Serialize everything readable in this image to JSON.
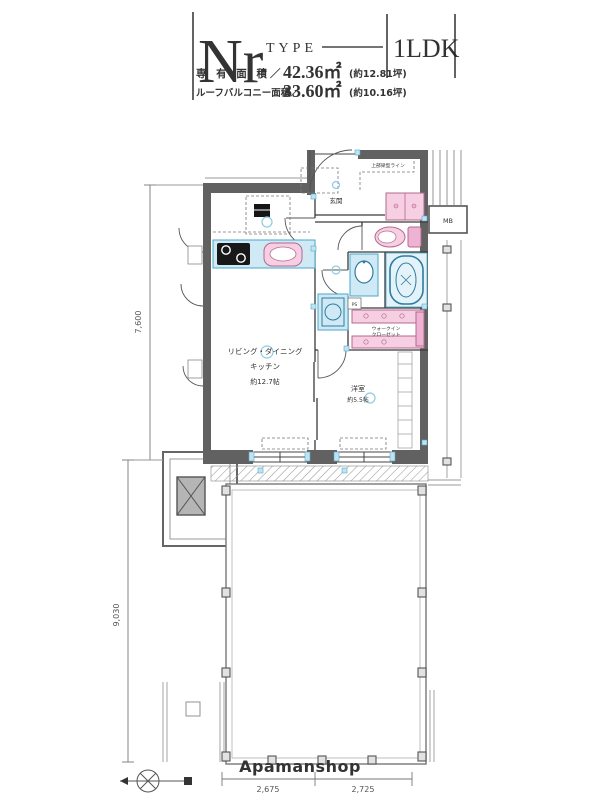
{
  "title_block": {
    "type_code": "Nr",
    "type_word": "TYPE",
    "plan_type": "1LDK",
    "areas": [
      {
        "label": "専 有 面 積／",
        "value": "42.36㎡",
        "tsubo": "(約12.81坪)"
      },
      {
        "label": "ルーフバルコニー面積／",
        "value": "33.60㎡",
        "tsubo": "(約10.16坪)"
      }
    ]
  },
  "floorplan": {
    "labels": {
      "entrance": "玄関",
      "ldk_line1": "リビング・ダイニング",
      "ldk_line2": "キッチン",
      "ldk_size": "約12.7帖",
      "bedroom": "洋室",
      "bedroom_size": "約5.5帖",
      "wic_line1": "ウォークイン",
      "wic_line2": "クローゼット",
      "roof_balcony": "ルーフバルコニー",
      "meter_box": "MB",
      "pipe_space": "PS",
      "beam_note": "上部梁型ライン"
    },
    "dimensions": {
      "upper_height": "7,600",
      "lower_height": "9,030",
      "bottom_width_left": "2,675",
      "bottom_width_right": "2,725"
    },
    "branding": "Apamanshop"
  },
  "colors": {
    "wall": "#616161",
    "fixture_blue": "#cfe9f5",
    "fixture_blue_stroke": "#4aa7cc",
    "fixture_pink": "#f6cfe2",
    "fixture_pink_stroke": "#b4688f",
    "dimension_line": "#777777"
  }
}
